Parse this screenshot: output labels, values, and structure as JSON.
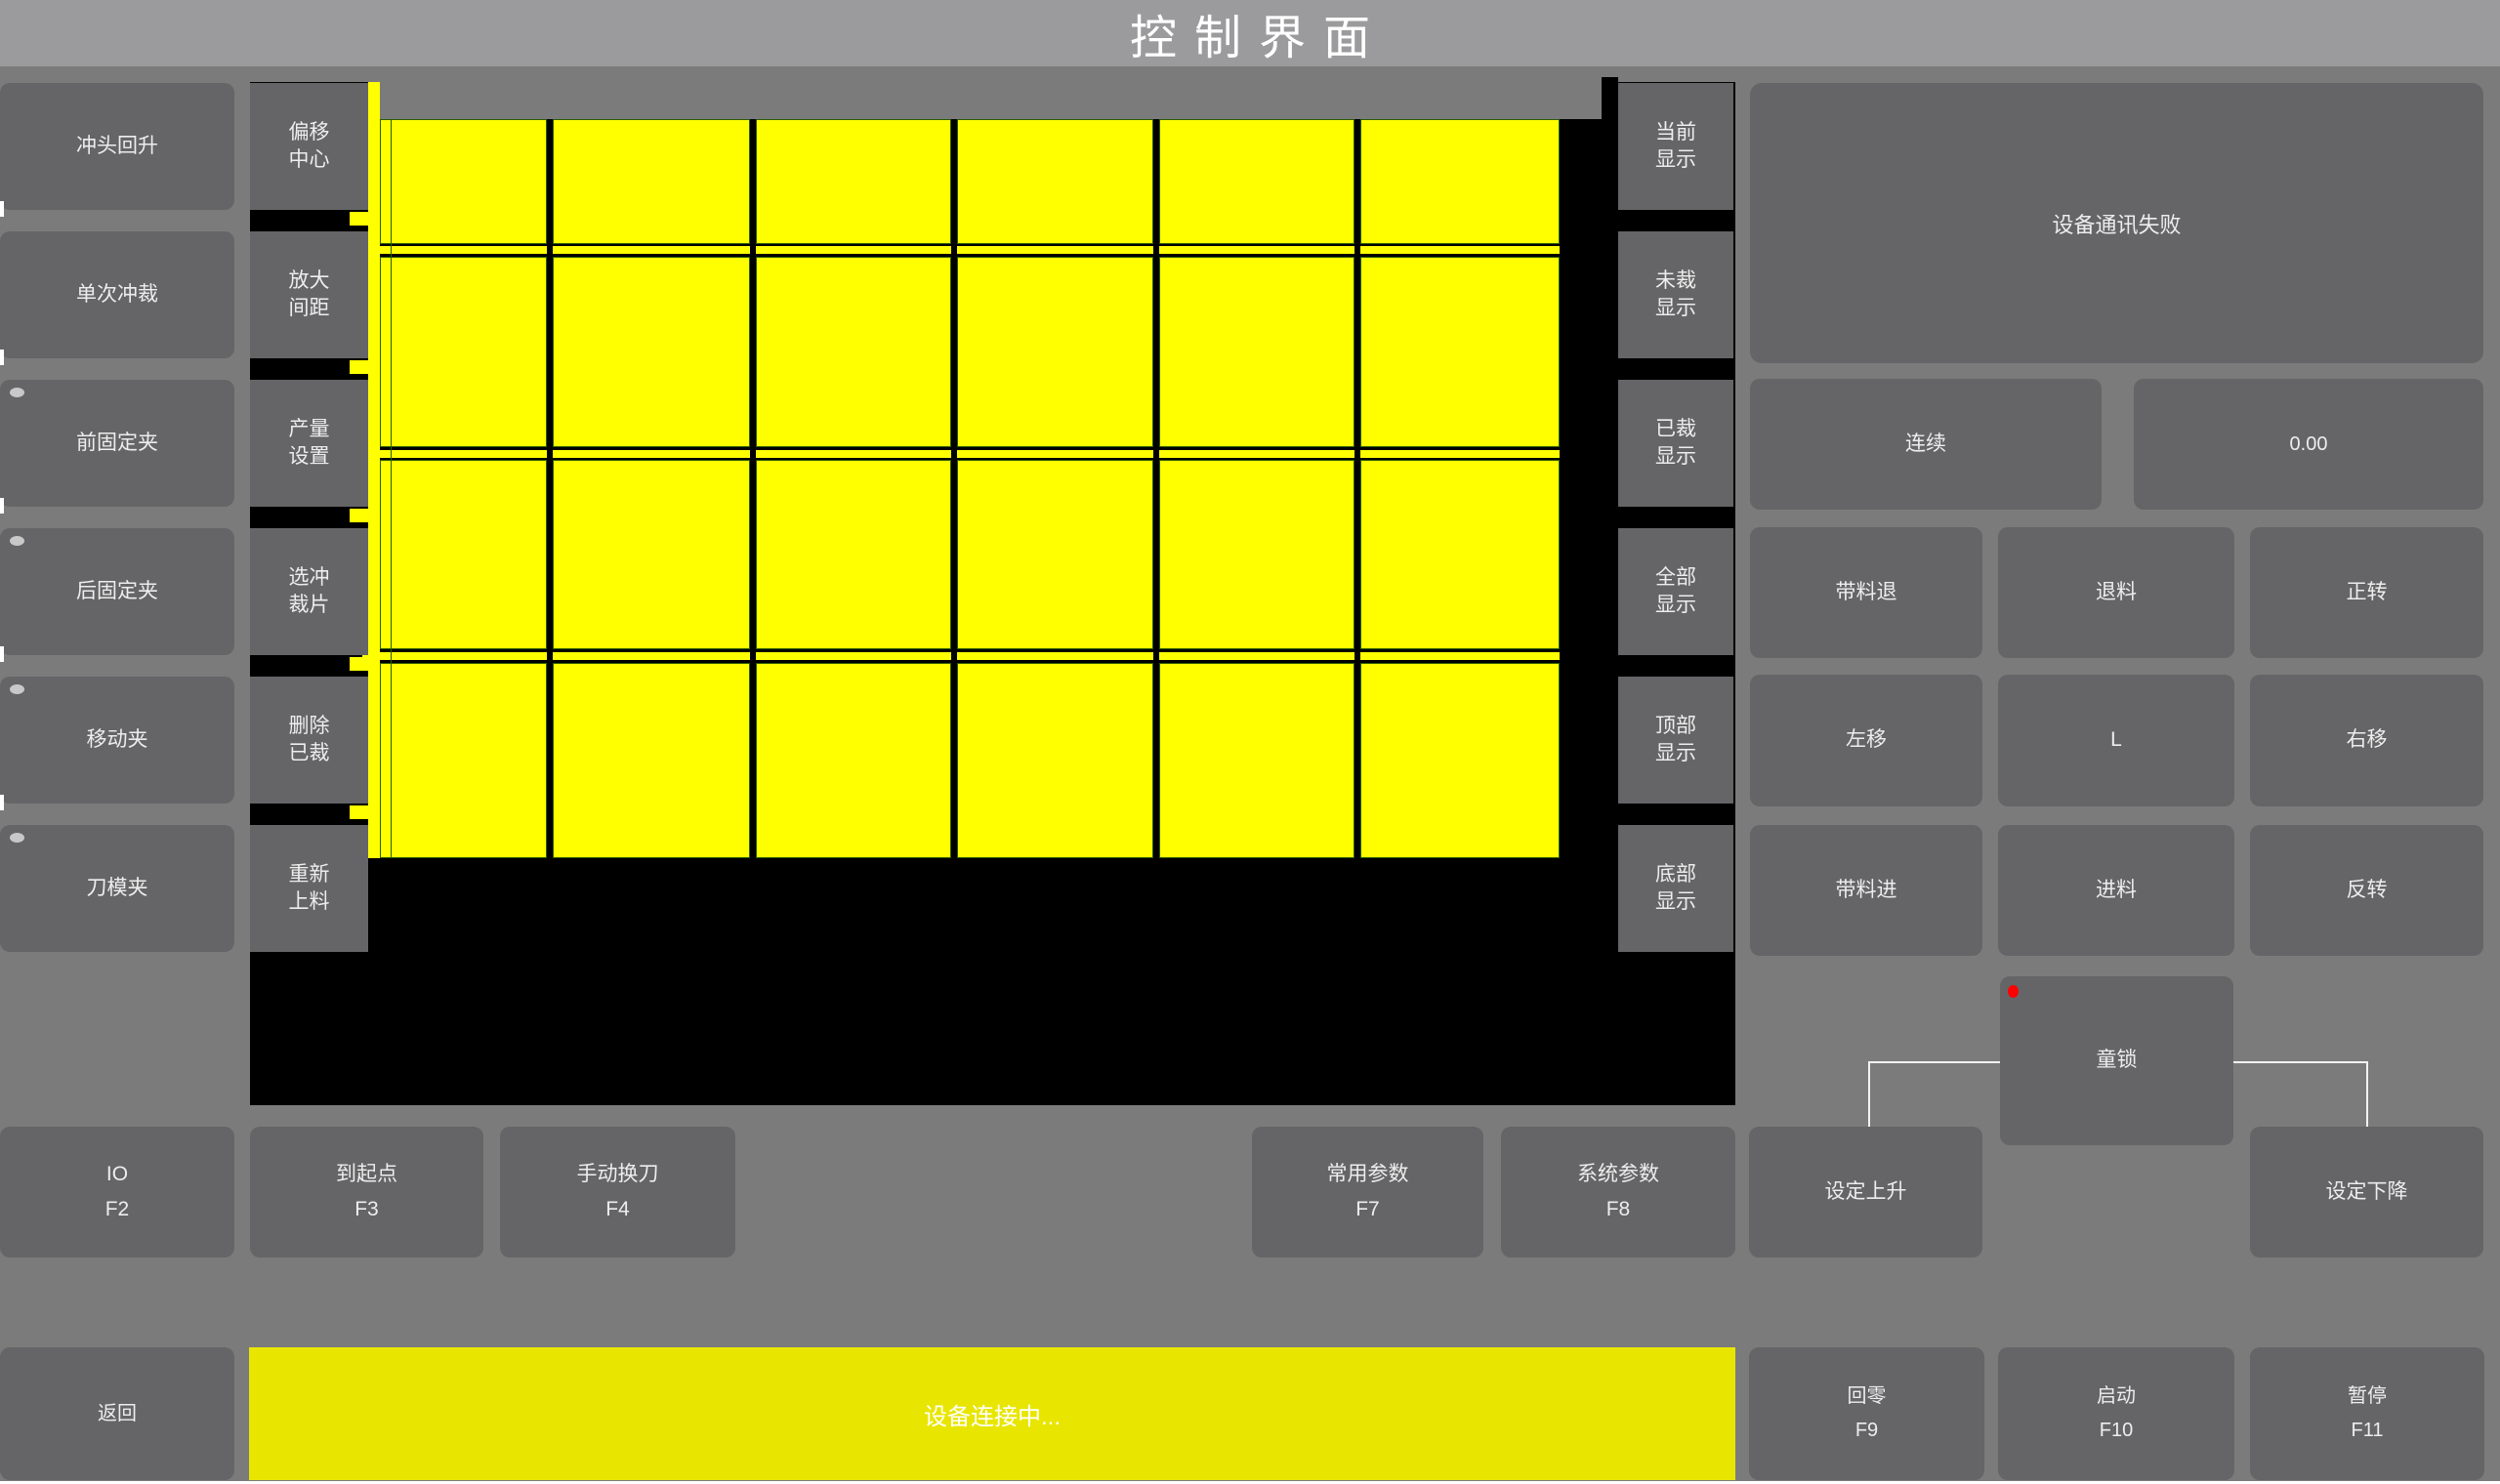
{
  "title": "控制界面",
  "colors": {
    "background": "#7b7b7b",
    "titlebar": "#9b9b9d",
    "button": "#656567",
    "canvas_black": "#000000",
    "piece_yellow": "#ffff00",
    "piece_outline": "#2b5d00",
    "status_bar_yellow": "#e8e600",
    "alert_red": "#ff0000",
    "connector_white": "#f2f2f2"
  },
  "left_actions": [
    {
      "label": "冲头回升",
      "indicator": false
    },
    {
      "label": "单次冲裁",
      "indicator": false
    },
    {
      "label": "前固定夹",
      "indicator": true
    },
    {
      "label": "后固定夹",
      "indicator": true
    },
    {
      "label": "移动夹",
      "indicator": true
    },
    {
      "label": "刀模夹",
      "indicator": true
    }
  ],
  "edit_actions": [
    {
      "lines": [
        "偏移",
        "中心"
      ]
    },
    {
      "lines": [
        "放大",
        "间距"
      ]
    },
    {
      "lines": [
        "产量",
        "设置"
      ]
    },
    {
      "lines": [
        "选冲",
        "裁片"
      ]
    },
    {
      "lines": [
        "删除",
        "已裁"
      ]
    },
    {
      "lines": [
        "重新",
        "上料"
      ]
    }
  ],
  "display_filters": [
    {
      "lines": [
        "当前",
        "显示"
      ]
    },
    {
      "lines": [
        "未裁",
        "显示"
      ]
    },
    {
      "lines": [
        "已裁",
        "显示"
      ]
    },
    {
      "lines": [
        "全部",
        "显示"
      ]
    },
    {
      "lines": [
        "顶部",
        "显示"
      ]
    },
    {
      "lines": [
        "底部",
        "显示"
      ]
    }
  ],
  "canvas": {
    "grid": {
      "columns": 6,
      "rows": 4
    }
  },
  "status_panel": {
    "message": "设备通讯失败"
  },
  "run_mode_button": {
    "label": "连续"
  },
  "speed_display": {
    "value": "0.00"
  },
  "jog_grid": {
    "rows": [
      [
        "带料退",
        "退料",
        "正转"
      ],
      [
        "左移",
        "L",
        "右移"
      ],
      [
        "带料进",
        "进料",
        "反转"
      ]
    ]
  },
  "child_lock": {
    "label": "童锁"
  },
  "function_row": [
    {
      "label": "IO",
      "key": "F2"
    },
    {
      "label": "到起点",
      "key": "F3"
    },
    {
      "label": "手动换刀",
      "key": "F4"
    },
    {
      "label": "常用参数",
      "key": "F7"
    },
    {
      "label": "系统参数",
      "key": "F8"
    },
    {
      "label": "设定上升",
      "key": ""
    },
    {
      "label": "设定下降",
      "key": ""
    }
  ],
  "bottom_bar": {
    "back_label": "返回",
    "status_message": "设备连接中...",
    "keys": [
      {
        "label": "回零",
        "key": "F9"
      },
      {
        "label": "启动",
        "key": "F10"
      },
      {
        "label": "暂停",
        "key": "F11"
      }
    ]
  }
}
